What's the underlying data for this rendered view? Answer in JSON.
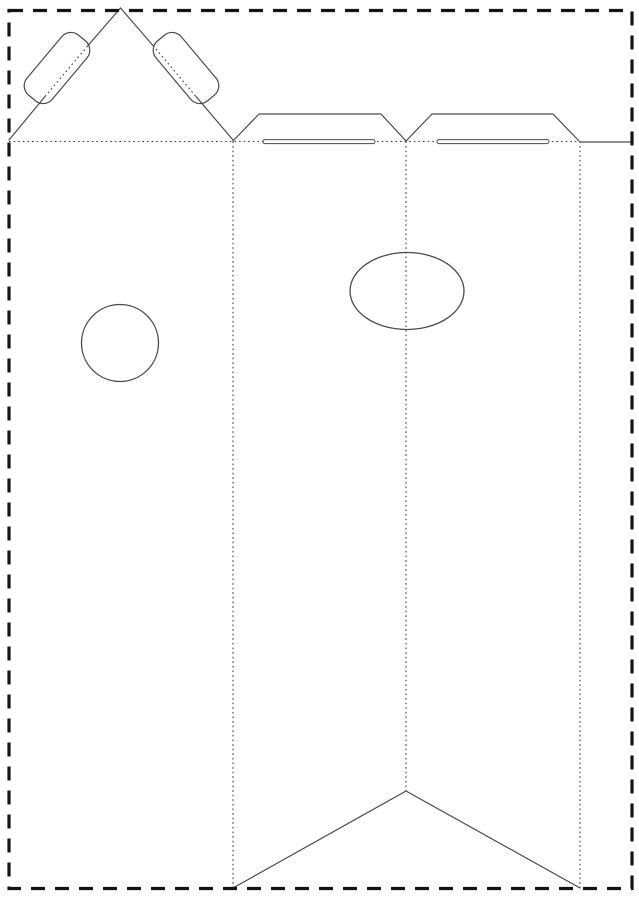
{
  "meta": {
    "title": "Papercraft carton / gift-bag template dieline",
    "canvas_width": 639,
    "canvas_height": 900,
    "background": "#ffffff"
  },
  "styles": {
    "border_color": "#141414",
    "cut_color": "#4a4a4a",
    "fold_color": "#3c3c3c",
    "slot_fill": "#ffffff",
    "border_stroke_width": 3.2,
    "border_dash": "14 10",
    "cut_stroke_width": 1.2,
    "fold_stroke_width": 1.1,
    "fold_dash": "1.6 3"
  },
  "diagram": {
    "border": {
      "name": "page-cut-border",
      "x": 9,
      "y": 10.5,
      "width": 623,
      "height": 878
    },
    "fold_lines": [
      {
        "name": "top-horizontal-fold",
        "x1": 9,
        "y1": 141.5,
        "x2": 580,
        "y2": 141.5
      },
      {
        "name": "left-vertical-fold",
        "x1": 233,
        "y1": 141.5,
        "x2": 233,
        "y2": 888
      },
      {
        "name": "center-vertical-fold",
        "x1": 406,
        "y1": 141.5,
        "x2": 406,
        "y2": 791
      },
      {
        "name": "right-vertical-fold",
        "x1": 580,
        "y1": 141.5,
        "x2": 580,
        "y2": 888
      },
      {
        "name": "left-tab-fold",
        "x1": 45,
        "y1": 96.5,
        "x2": 88,
        "y2": 45.5
      },
      {
        "name": "right-tab-fold",
        "x1": 153,
        "y1": 45.5,
        "x2": 196,
        "y2": 96.5
      }
    ],
    "cut_segments": [
      {
        "name": "roof-left-outer",
        "x1": 9,
        "y1": 140,
        "x2": 45,
        "y2": 96.5
      },
      {
        "name": "roof-left-peak",
        "x1": 88,
        "y1": 45.5,
        "x2": 120.5,
        "y2": 8
      },
      {
        "name": "roof-right-peak",
        "x1": 120.5,
        "y1": 8,
        "x2": 153,
        "y2": 45.5
      },
      {
        "name": "roof-right-outer",
        "x1": 196,
        "y1": 96.5,
        "x2": 233,
        "y2": 140
      },
      {
        "name": "glue-strip-top",
        "x1": 580,
        "y1": 142,
        "x2": 631,
        "y2": 142
      }
    ],
    "cut_polylines": [
      {
        "name": "top-flap-left",
        "points": "233,141 259,114 381,114 406,141"
      },
      {
        "name": "top-flap-right",
        "points": "406,141 432,114 553,114 579,141"
      },
      {
        "name": "bottom-chevron",
        "points": "233,888 406,791 580,888"
      }
    ],
    "tabs": [
      {
        "name": "roof-tab-left",
        "cx": 57,
        "cy": 68,
        "length": 78,
        "width": 33,
        "radius": 12,
        "angle": -50
      },
      {
        "name": "roof-tab-right",
        "cx": 186,
        "cy": 68,
        "length": 78,
        "width": 33,
        "radius": 12,
        "angle": 50
      }
    ],
    "slots": [
      {
        "name": "handle-slot-left",
        "x": 263,
        "y": 139.6,
        "width": 112,
        "height": 4,
        "rx": 2
      },
      {
        "name": "handle-slot-right",
        "x": 437,
        "y": 139.6,
        "width": 112,
        "height": 4,
        "rx": 2
      }
    ],
    "holes": [
      {
        "name": "punch-hole-circle",
        "type": "circle",
        "cx": 120,
        "cy": 343,
        "r": 38.5
      },
      {
        "name": "hang-hole-ellipse",
        "type": "ellipse",
        "cx": 407,
        "cy": 291,
        "rx": 57,
        "ry": 38.5
      }
    ]
  }
}
